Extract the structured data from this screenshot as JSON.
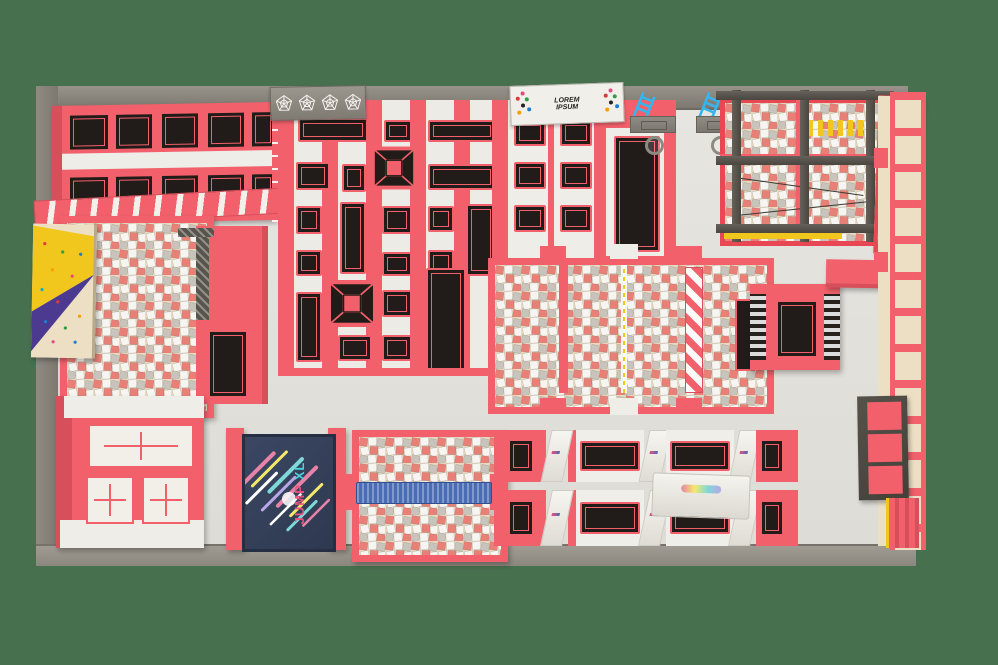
{
  "scene": {
    "description": "3D top-down render of an indoor trampoline park floor plan"
  },
  "palette": {
    "green_bg": "#47704f",
    "wall": "#97928a",
    "wall_dark": "#7d7870",
    "floor": "#e3e1dc",
    "floor_bright": "#edebe6",
    "red": "#f2606b",
    "red_dark": "#d84f5c",
    "bed_black": "#211c19",
    "foam_base": "#e7d9c0",
    "foam_red": "#e98078",
    "foam_white": "#f7f5f1",
    "foam_gray": "#c8c4bc",
    "scaffold": "#57544c",
    "yellow": "#f2c71d",
    "purple": "#4c3a90",
    "tan": "#ecdfc4",
    "blue": "#35b5ee",
    "beam_blue": "#4a6cb4",
    "navy": "#36415a",
    "net_red": "#e84853"
  },
  "banner": {
    "line1": "LOREM",
    "line2": "IPSUM"
  },
  "screen": {
    "word1": "JUMP",
    "word2": "XL"
  }
}
